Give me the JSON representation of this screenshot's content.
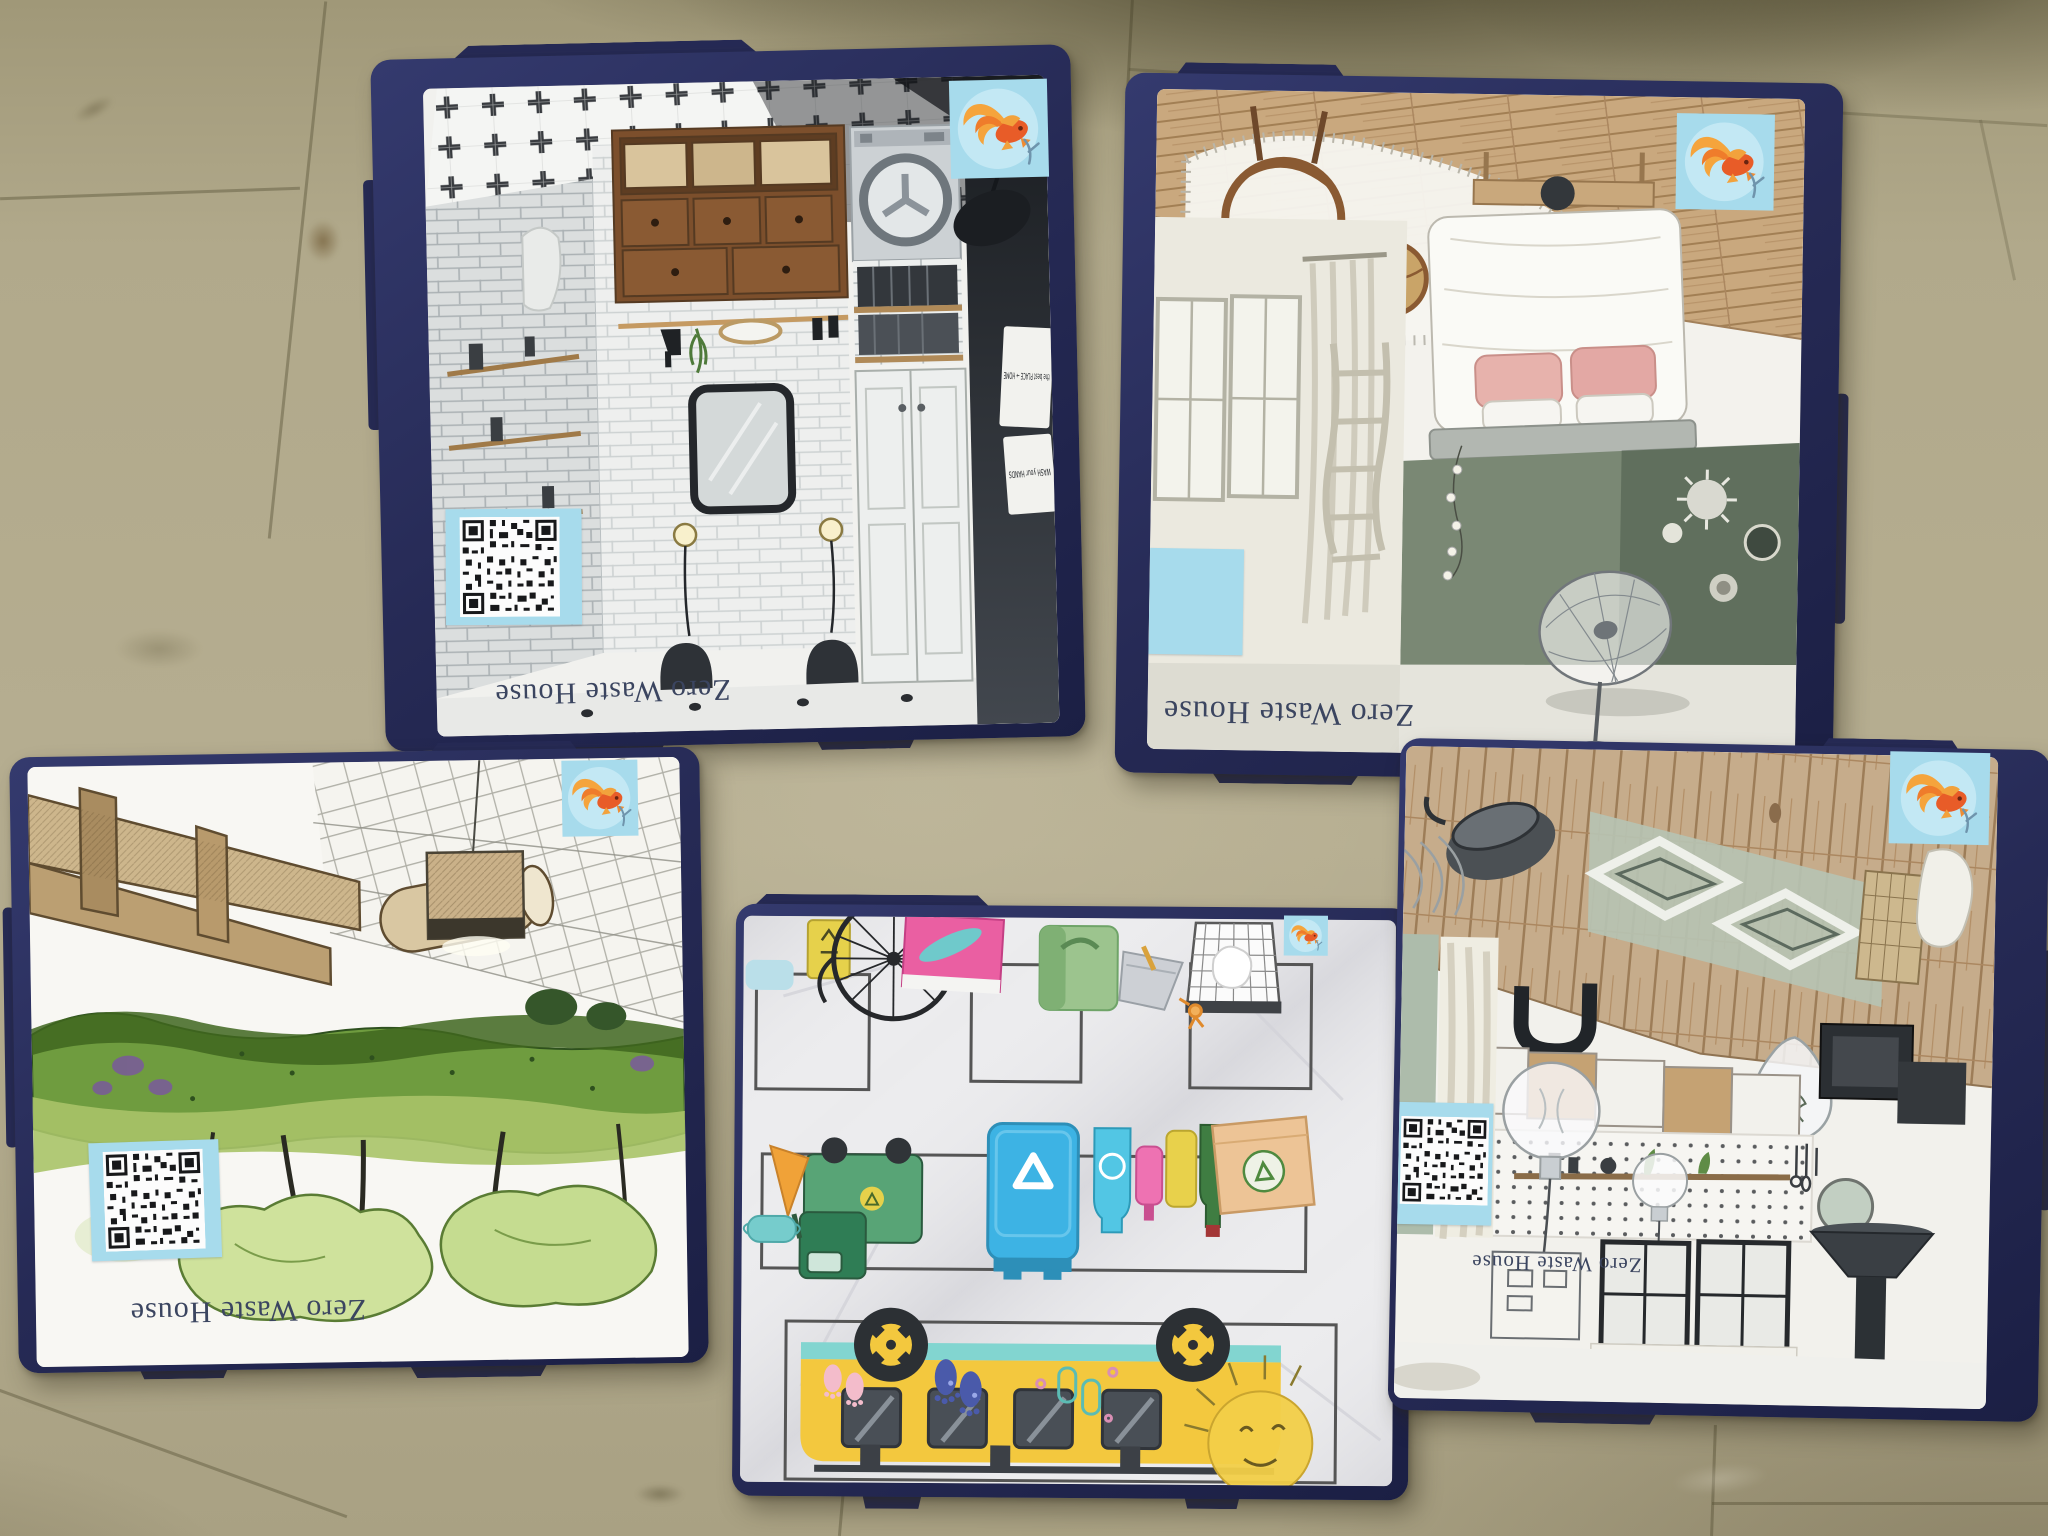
{
  "scene": {
    "type": "photograph",
    "floor_color": "#b1a98b",
    "box_color": "#262a55",
    "sticker_color": "#a7dbec",
    "brand_text_color": "#3b4560"
  },
  "brand_label": "Zero Waste House",
  "boxes": [
    {
      "name": "laundry-room-box",
      "label": "Zero Waste House",
      "signs": [
        "the best PLACE → HOME",
        "WASH your HANDS"
      ],
      "stickers": [
        "qr-code",
        "goldfish-logo"
      ]
    },
    {
      "name": "bedroom-box",
      "label": "Zero Waste House",
      "stickers": [
        "blank-patch",
        "goldfish-logo"
      ]
    },
    {
      "name": "green-wall-box",
      "label": "Zero Waste House",
      "stickers": [
        "qr-code",
        "goldfish-logo"
      ]
    },
    {
      "name": "recycling-poster-box",
      "label": "",
      "stickers": [
        "goldfish-logo"
      ]
    },
    {
      "name": "kitchen-box",
      "label": "Zero Waste House",
      "stickers": [
        "qr-code",
        "goldfish-logo"
      ]
    }
  ]
}
